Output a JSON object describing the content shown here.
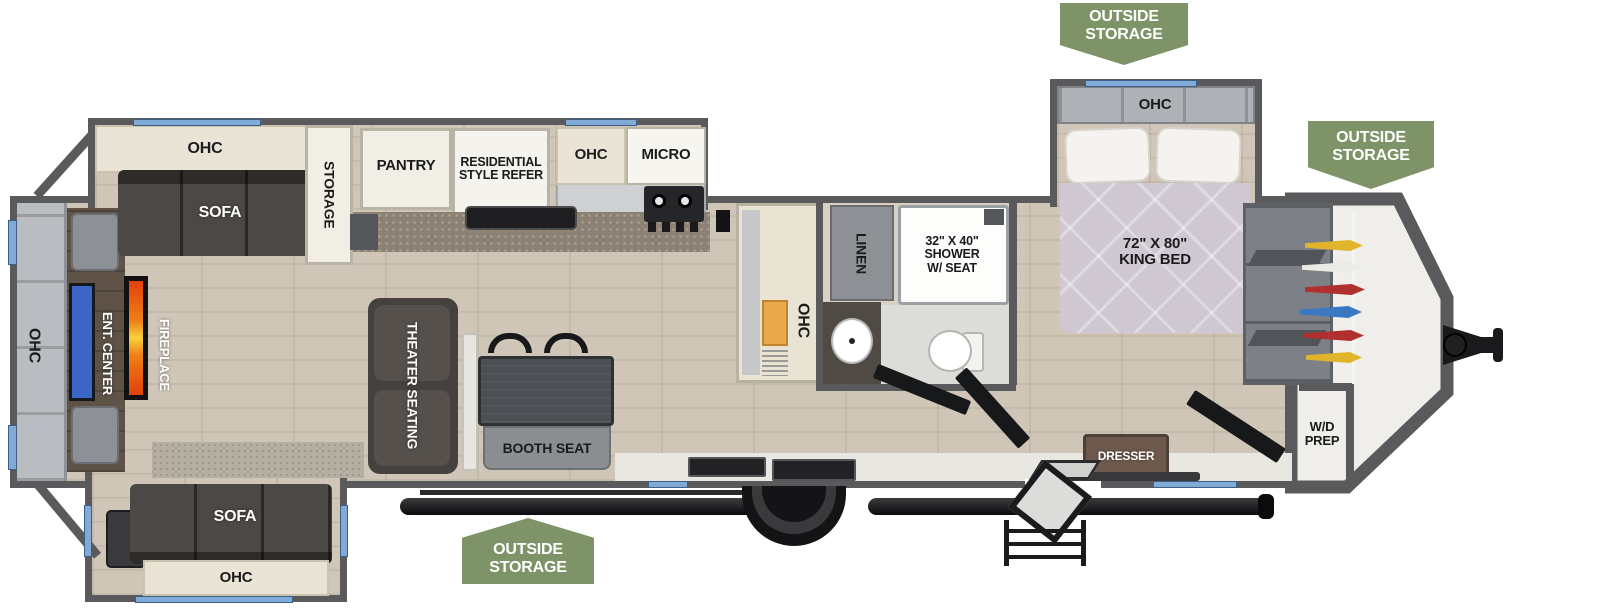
{
  "title": "Travel trailer floor plan",
  "colors": {
    "badge_green": "#7e9468",
    "wall_gray": "#5a5a5c",
    "window_blue": "#80abd8",
    "floor_wood": "#cfc6b7",
    "counter_brown": "#8d8173",
    "sofa_dark": "#4c4845",
    "bed_lavender": "#cfc8d2",
    "tv_blue": "#3a66c8",
    "fireplace_orange": "#f08018"
  },
  "badges": {
    "top": "OUTSIDE STORAGE",
    "right": "OUTSIDE STORAGE",
    "bottom": "OUTSIDE STORAGE"
  },
  "rear": {
    "ohc": "OHC",
    "ent_center": "ENT. CENTER",
    "fireplace": "FIREPLACE"
  },
  "living": {
    "ohc_top": "OHC",
    "sofa_top": "SOFA",
    "storage": "STORAGE",
    "theater": "THEATER SEATING",
    "booth": "BOOTH SEAT",
    "sofa_bottom": "SOFA",
    "ohc_bottom": "OHC"
  },
  "kitchen": {
    "pantry": "PANTRY",
    "refer": "RESIDENTIAL\nSTYLE REFER",
    "ohc": "OHC",
    "micro": "MICRO",
    "entry_ohc": "OHC"
  },
  "bath": {
    "linen": "LINEN",
    "shower": "32\" X 40\"\nSHOWER\nW/ SEAT"
  },
  "bedroom": {
    "ohc": "OHC",
    "king_bed": "72\" X 80\"\nKING BED",
    "dresser": "DRESSER",
    "wd_prep": "W/D\nPREP"
  }
}
